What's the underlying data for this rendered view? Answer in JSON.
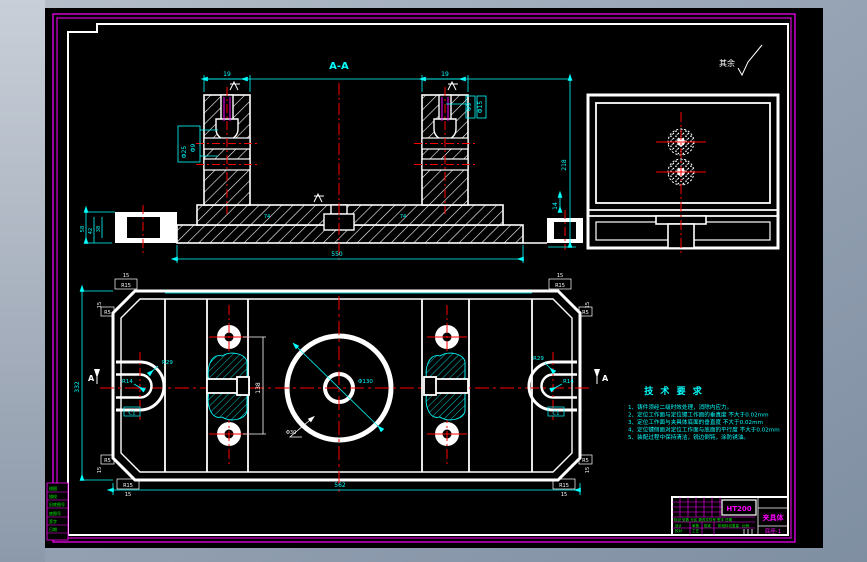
{
  "canvas": {
    "section_label": "A-A",
    "surface_note": "其余"
  },
  "colors": {
    "outline": "#ffffff",
    "dimension": "#00ffff",
    "centerline": "#ff0000",
    "sheet_border": "#ff00ff",
    "minor_text": "#00ff00",
    "paper": "#000000"
  },
  "front": {
    "dims": {
      "tower_width": "19",
      "bore_large": "Φ25",
      "bore_small": "Φ9",
      "cbore_d": "Φ9",
      "cbore_D": "Φ15",
      "total_height": "218",
      "step_height": "14",
      "slot_width": "74",
      "base_length": "550",
      "end_h1": "58",
      "end_h2": "42",
      "end_h3": "38"
    }
  },
  "plan": {
    "marker": "A",
    "dims": {
      "length": "562",
      "width": "332",
      "hole_pitch": "138",
      "slot_outer": "R29",
      "slot_inner": "R14",
      "chamfer": "C1",
      "corner_radius": "R15",
      "corner_size": "15",
      "fillet": "R5",
      "bore": "Φ130",
      "hub": "Φ30"
    }
  },
  "notes": {
    "title": "技 术 要 求",
    "items": [
      "1、铸件须经二级时效处理，消除内应力。",
      "2、定位工作面与定位键工作面的垂直度 不大于0.02mm",
      "3、定位工作面与夹具体底面的垂直度 不大于0.02mm",
      "4、定位键侧面对定位工作面与底面的平行度 不大于0.02mm",
      "5、装配过程中保持清洁，锐边倒钝，涂防锈油。"
    ]
  },
  "title_block": {
    "material": "HT200",
    "part_name": "夹具体",
    "sheet_no": "底座-1",
    "header_row": "标记 处数 分区 更改文件号 签字 日期",
    "rows": [
      "设计",
      "校对",
      "审核",
      "工艺",
      "批准"
    ],
    "scale_label": "比例",
    "stage_label": "阶段标记",
    "weight_label": "重量"
  },
  "margin": {
    "labels": [
      "描图",
      "描校",
      "旧底图号",
      "底图号",
      "签字",
      "日期"
    ]
  }
}
